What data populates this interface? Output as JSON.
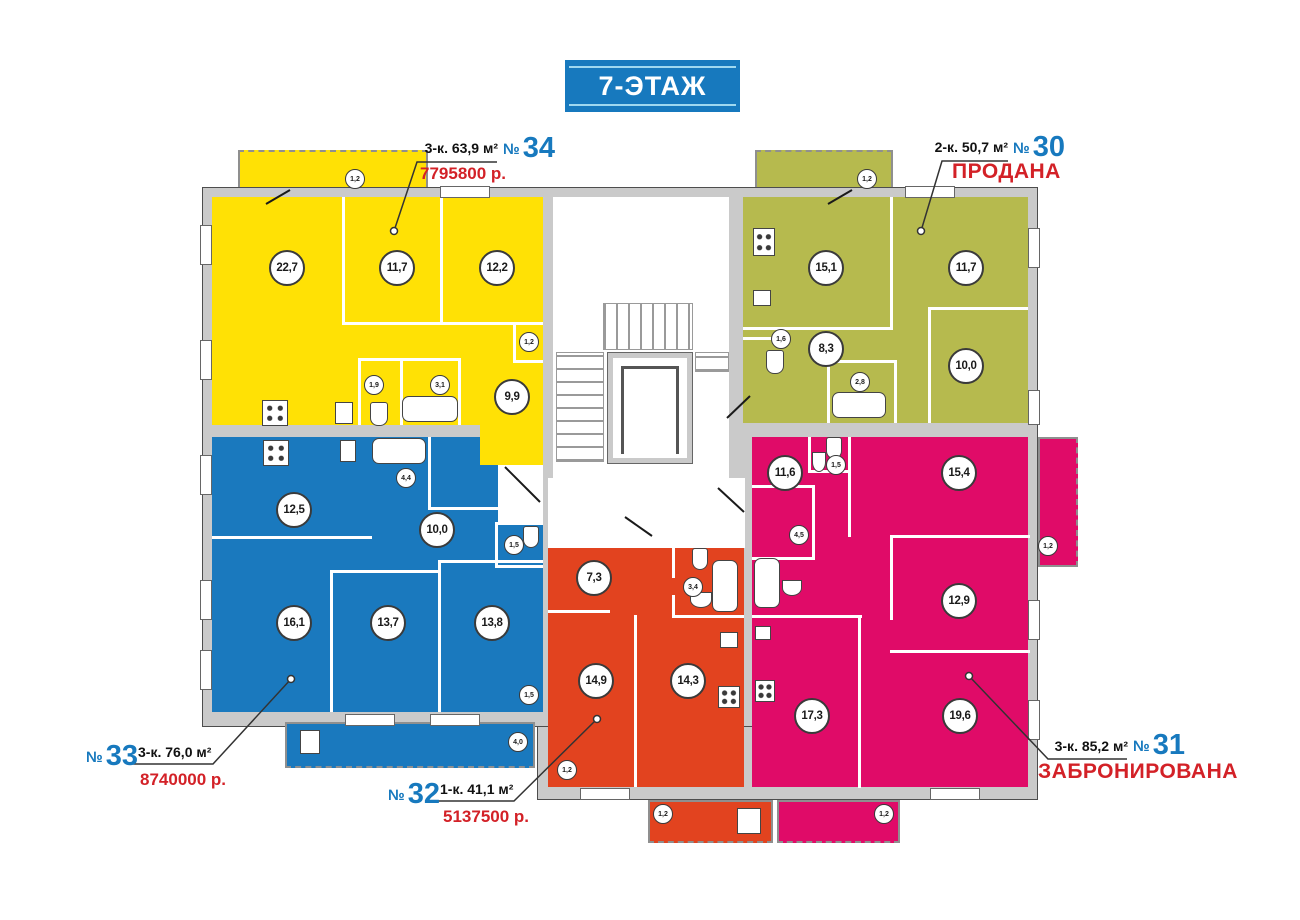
{
  "title": "7-ЭТАЖ",
  "labels": {
    "number_sign": "№"
  },
  "colors": {
    "banner": "#1779be",
    "apartment_yellow": "#ffe105",
    "apartment_olive": "#b6ba4e",
    "apartment_blue": "#1a79be",
    "apartment_red": "#e2431f",
    "apartment_pink": "#e00b68",
    "price_red": "#d32127",
    "number_blue": "#1779be",
    "wall_grey": "#cacaca"
  },
  "apartments": [
    {
      "number": "34",
      "spec": "3-к. 63,9 м²",
      "price": "7795800 р.",
      "rooms": [
        "22,7",
        "11,7",
        "12,2",
        "1,2",
        "1,9",
        "3,1",
        "9,9"
      ],
      "balconies": [
        "1,2"
      ]
    },
    {
      "number": "30",
      "spec": "2-к. 50,7 м²",
      "status": "ПРОДАНА",
      "rooms": [
        "15,1",
        "11,7",
        "1,6",
        "8,3",
        "2,8",
        "10,0"
      ],
      "balconies": [
        "1,2"
      ]
    },
    {
      "number": "33",
      "spec": "3-к. 76,0 м²",
      "price": "8740000 р.",
      "rooms": [
        "12,5",
        "4,4",
        "10,0",
        "1,5",
        "16,1",
        "13,7",
        "13,8",
        "1,5"
      ],
      "balconies": [
        "4,0"
      ]
    },
    {
      "number": "32",
      "spec": "1-к. 41,1 м²",
      "price": "5137500 р.",
      "rooms": [
        "7,3",
        "3,4",
        "14,9",
        "14,3",
        "1,2"
      ],
      "balconies": [
        "1,2"
      ]
    },
    {
      "number": "31",
      "spec": "3-к. 85,2 м²",
      "status": "ЗАБРОНИРОВАНА",
      "rooms": [
        "11,6",
        "1,5",
        "15,4",
        "4,5",
        "12,9",
        "17,3",
        "19,6"
      ],
      "balconies": [
        "1,2",
        "1,2"
      ]
    }
  ]
}
